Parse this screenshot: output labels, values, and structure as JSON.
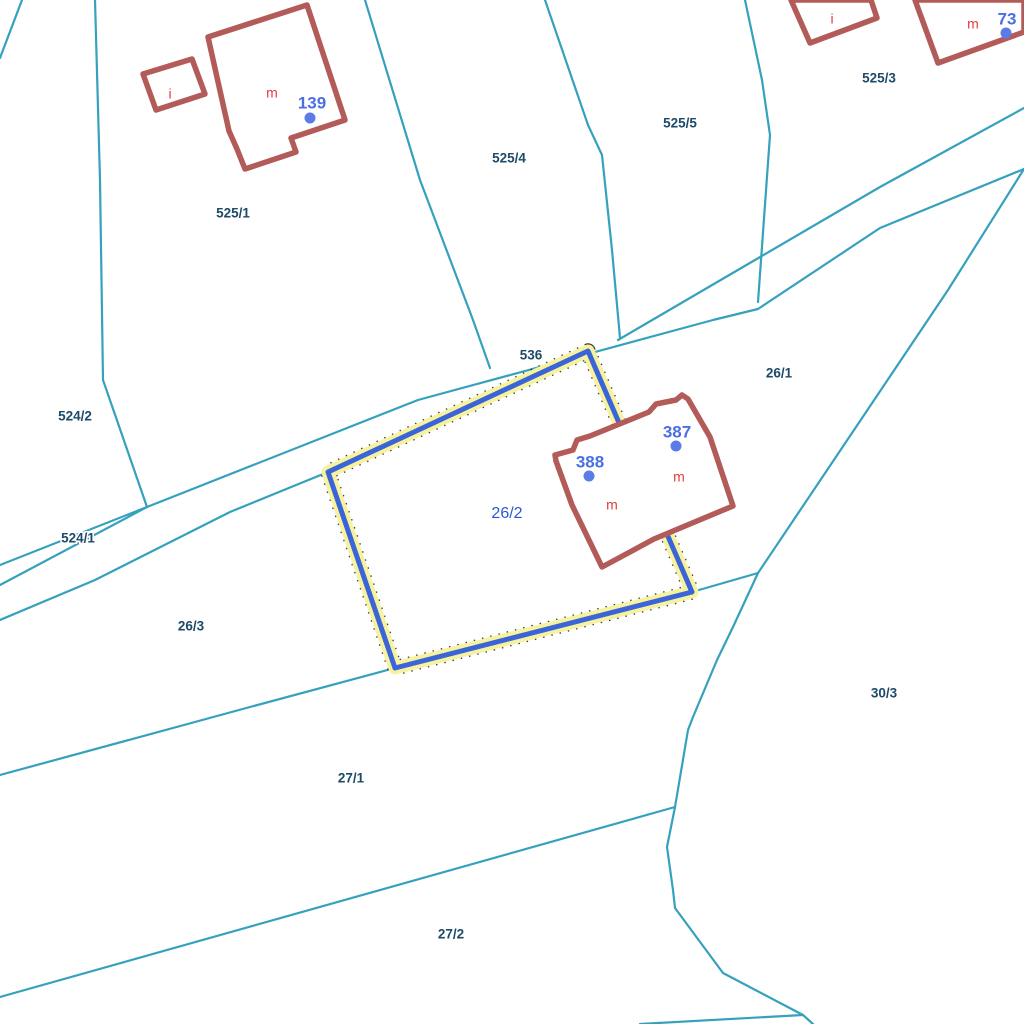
{
  "map": {
    "title": "cadastral-parcel-map",
    "background": "#ffffff",
    "colors": {
      "boundary": "#35A1BD",
      "building_stroke": "#B25B59",
      "building_fill": "#ffffff",
      "building_letter": "#E03C3C",
      "building_number": "#4A6FE3",
      "building_dot": "#5B7BE6",
      "parcel_label": "#1E4A68",
      "selected_label": "#2D55D6",
      "highlight_blue": "#3B64D8",
      "highlight_halo": "#F6F2A0",
      "highlight_dots": "#1a1a1a"
    },
    "boundaries": [
      {
        "name": "corner-cut-top-left",
        "points": [
          [
            22,
            0
          ],
          [
            0,
            58
          ]
        ]
      },
      {
        "name": "boundary-524-2-525-1",
        "points": [
          [
            95,
            0
          ],
          [
            100,
            180
          ],
          [
            103,
            380
          ],
          [
            147,
            507
          ]
        ]
      },
      {
        "name": "boundary-525-1-525-4",
        "points": [
          [
            365,
            0
          ],
          [
            420,
            180
          ],
          [
            473,
            320
          ],
          [
            490,
            368
          ]
        ]
      },
      {
        "name": "boundary-525-4-525-5",
        "points": [
          [
            545,
            0
          ],
          [
            588,
            125
          ],
          [
            602,
            155
          ],
          [
            612,
            250
          ],
          [
            620,
            338
          ]
        ]
      },
      {
        "name": "boundary-525-5-525-3",
        "points": [
          [
            745,
            0
          ],
          [
            762,
            80
          ],
          [
            770,
            135
          ],
          [
            758,
            302
          ]
        ]
      },
      {
        "name": "road-536-upper-edge",
        "points": [
          [
            0,
            565
          ],
          [
            147,
            507
          ],
          [
            418,
            400
          ],
          [
            713,
            320
          ],
          [
            758,
            309
          ],
          [
            880,
            228
          ],
          [
            1024,
            169
          ]
        ]
      },
      {
        "name": "road-536-upper-branch",
        "points": [
          [
            618,
            340
          ],
          [
            880,
            187
          ],
          [
            1024,
            108
          ]
        ]
      },
      {
        "name": "boundary-26-1-30-3",
        "points": [
          [
            1024,
            169
          ],
          [
            948,
            290
          ],
          [
            758,
            573
          ]
        ]
      },
      {
        "name": "junction-branch",
        "points": [
          [
            758,
            573
          ],
          [
            692,
            592
          ]
        ]
      },
      {
        "name": "boundary-27-1-30-3-curve",
        "points": [
          [
            758,
            573
          ],
          [
            733,
            627
          ],
          [
            717,
            660
          ],
          [
            693,
            717
          ],
          [
            688,
            730
          ],
          [
            675,
            807
          ],
          [
            667,
            847
          ],
          [
            673,
            890
          ],
          [
            675,
            908
          ],
          [
            723,
            973
          ],
          [
            803,
            1015
          ],
          [
            813,
            1024
          ]
        ]
      },
      {
        "name": "boundary-27-1-27-2",
        "points": [
          [
            0,
            997
          ],
          [
            675,
            807
          ]
        ]
      },
      {
        "name": "boundary-26-3-27-1",
        "points": [
          [
            0,
            775
          ],
          [
            250,
            707
          ],
          [
            395,
            668
          ]
        ]
      },
      {
        "name": "bottom-right-branch",
        "points": [
          [
            640,
            1024
          ],
          [
            803,
            1015
          ]
        ]
      },
      {
        "name": "road-524-1-lower-edge",
        "points": [
          [
            0,
            620
          ],
          [
            95,
            580
          ],
          [
            230,
            512
          ],
          [
            328,
            472
          ]
        ]
      },
      {
        "name": "road-524-1-inner-edge",
        "points": [
          [
            0,
            585
          ],
          [
            147,
            507
          ]
        ]
      }
    ],
    "selected_parcel": {
      "id": "26/2",
      "points": [
        [
          588,
          351
        ],
        [
          692,
          592
        ],
        [
          395,
          668
        ],
        [
          328,
          472
        ]
      ],
      "label": {
        "text": "26/2",
        "x": 507,
        "y": 514
      }
    },
    "buildings": [
      {
        "name": "building-139",
        "points": [
          [
            208,
            37
          ],
          [
            307,
            5
          ],
          [
            345,
            120
          ],
          [
            291,
            138
          ],
          [
            296,
            152
          ],
          [
            245,
            169
          ],
          [
            237,
            149
          ],
          [
            229,
            131
          ]
        ]
      },
      {
        "name": "building-i-small-left",
        "points": [
          [
            143,
            74
          ],
          [
            192,
            59
          ],
          [
            205,
            94
          ],
          [
            156,
            110
          ]
        ]
      },
      {
        "name": "building-complex-387-388",
        "points": [
          [
            555,
            455
          ],
          [
            573,
            450
          ],
          [
            577,
            440
          ],
          [
            590,
            436
          ],
          [
            649,
            412
          ],
          [
            656,
            404
          ],
          [
            676,
            400
          ],
          [
            682,
            395
          ],
          [
            688,
            399
          ],
          [
            710,
            437
          ],
          [
            733,
            506
          ],
          [
            654,
            539
          ],
          [
            602,
            567
          ],
          [
            572,
            505
          ],
          [
            556,
            461
          ]
        ]
      },
      {
        "name": "building-i-top-right",
        "points": [
          [
            791,
            0
          ],
          [
            810,
            43
          ],
          [
            877,
            18
          ],
          [
            871,
            0
          ]
        ]
      },
      {
        "name": "building-m-top-right",
        "points": [
          [
            915,
            0
          ],
          [
            938,
            63
          ],
          [
            1024,
            32
          ],
          [
            1024,
            0
          ]
        ]
      }
    ],
    "building_letters": [
      {
        "text": "i",
        "x": 170,
        "y": 95
      },
      {
        "text": "m",
        "x": 272,
        "y": 94
      },
      {
        "text": "m",
        "x": 612,
        "y": 506
      },
      {
        "text": "m",
        "x": 679,
        "y": 478
      },
      {
        "text": "i",
        "x": 832,
        "y": 20
      },
      {
        "text": "m",
        "x": 973,
        "y": 25
      }
    ],
    "building_numbers": [
      {
        "text": "139",
        "x": 312,
        "y": 104,
        "dot": {
          "x": 310,
          "y": 118
        }
      },
      {
        "text": "388",
        "x": 590,
        "y": 463,
        "dot": {
          "x": 589,
          "y": 476
        }
      },
      {
        "text": "387",
        "x": 677,
        "y": 433,
        "dot": {
          "x": 676,
          "y": 446
        }
      },
      {
        "text": "73",
        "x": 1007,
        "y": 20,
        "dot": {
          "x": 1006,
          "y": 33
        }
      }
    ],
    "parcel_labels": [
      {
        "text": "525/1",
        "x": 233,
        "y": 214
      },
      {
        "text": "525/4",
        "x": 509,
        "y": 159
      },
      {
        "text": "525/5",
        "x": 680,
        "y": 124
      },
      {
        "text": "525/3",
        "x": 879,
        "y": 79
      },
      {
        "text": "524/2",
        "x": 75,
        "y": 417
      },
      {
        "text": "524/1",
        "x": 78,
        "y": 539
      },
      {
        "text": "536",
        "x": 531,
        "y": 356
      },
      {
        "text": "26/1",
        "x": 779,
        "y": 374
      },
      {
        "text": "26/3",
        "x": 191,
        "y": 627
      },
      {
        "text": "30/3",
        "x": 884,
        "y": 694
      },
      {
        "text": "27/1",
        "x": 351,
        "y": 779
      },
      {
        "text": "27/2",
        "x": 451,
        "y": 935
      }
    ]
  }
}
